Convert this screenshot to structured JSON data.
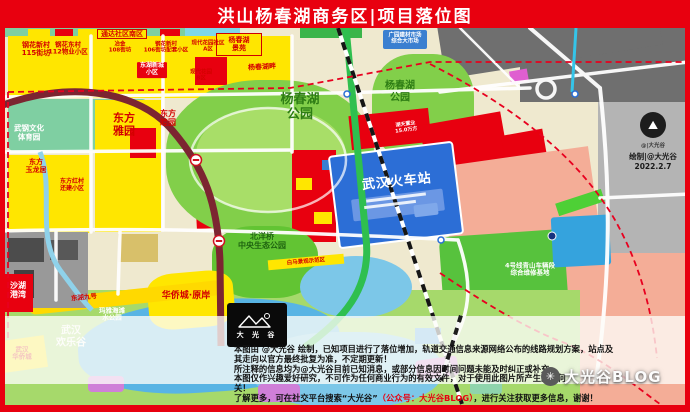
{
  "header": {
    "title": "洪山杨春湖商务区|项目落位图"
  },
  "colors": {
    "header_red": "#e8000f",
    "parcel_yellow": "#ffe600",
    "parcel_red": "#e8000f",
    "park_green": "#82cf4a",
    "station_blue": "#2c6ed6",
    "water_blue": "#58b4e4",
    "salmon": "#f4ad97",
    "gray_outside": "#b4b4b4"
  },
  "map": {
    "labels": [
      {
        "id": "ganghua-115",
        "text": "钢花新村\n115街坊"
      },
      {
        "id": "ganghua-112",
        "text": "钢花东村\n112物业小区"
      },
      {
        "id": "tongda",
        "text": "通达社区南区"
      },
      {
        "id": "yejin-108",
        "text": "冶金\n108街坊"
      },
      {
        "id": "ganghua-106",
        "text": "钢花新村\n106街坊配套小区"
      },
      {
        "id": "xiandai-a",
        "text": "现代花园社区\nA区"
      },
      {
        "id": "donghu-xincheng",
        "text": "东湖新城\n小区"
      },
      {
        "id": "xiandai-b",
        "text": "现代花园\nB区"
      },
      {
        "id": "yangchunhu-jingyuan",
        "text": "杨春湖\n景苑"
      },
      {
        "id": "yangchunhu-pan",
        "text": "杨春湖畔"
      },
      {
        "id": "jiancai-market",
        "text": "广园建材市场\n综合大市场"
      },
      {
        "id": "park-west",
        "text": "杨春湖\n公园"
      },
      {
        "id": "park-east",
        "text": "杨春湖\n公园"
      },
      {
        "id": "dongfang-yayuan",
        "text": "东方\n雅园"
      },
      {
        "id": "dongfang-muyuan",
        "text": "东方\n睦园"
      },
      {
        "id": "wugang-sports-park",
        "text": "武钢文化\n体育园"
      },
      {
        "id": "dongfang-yulongju",
        "text": "东方\n玉龙居"
      },
      {
        "id": "dongfanghongcun",
        "text": "东方红村\n还建小区"
      },
      {
        "id": "wuhan-railway-station",
        "text": "武汉火车站"
      },
      {
        "id": "hutian",
        "text": "湖天置业\n15.0万方"
      },
      {
        "id": "beiyangqiao-park",
        "text": "北洋桥\n中央生态公园"
      },
      {
        "id": "shahu-gangwan",
        "text": "沙湖\n港湾"
      },
      {
        "id": "donghu-no9",
        "text": "东湖九号"
      },
      {
        "id": "oct-yuanan",
        "text": "华侨城·原岸"
      },
      {
        "id": "maya-beach",
        "text": "玛雅海滩\n水公园"
      },
      {
        "id": "happy-valley",
        "text": "武汉\n欢乐谷"
      },
      {
        "id": "wuhan-oct",
        "text": "武汉\n华侨城"
      },
      {
        "id": "line4-depot",
        "text": "4号线青山车辆段\n综合维修基地"
      },
      {
        "id": "baima",
        "text": "白马景观示范区"
      }
    ]
  },
  "logo": {
    "text": "大 光 谷"
  },
  "credit": {
    "handle": "@|大光谷",
    "line": "绘制|@大光谷",
    "date": "2022.2.7"
  },
  "watermark": {
    "icon": "sparkle-icon",
    "text": "大光谷BLOG"
  },
  "disclaimer": {
    "l1": "本图由 @大光谷 绘制，已知项目进行了落位增加，轨道交通信息来源网络公布的线路规划方案，站点及",
    "l2": "其走向以官方最终批复为准，不定期更新！",
    "l3": "所注释的信息均为@大光谷目前已知消息，或部分信息因时间问题未能及时纠正或补充。",
    "l4": "本图仅作兴趣爱好研究，不可作为任何商业行为的有效文件，对于使用此图片所产生的任何",
    "l5": "关！",
    "l6a": "了解更多，可在社交平台搜索“大光谷”",
    "l6b": "（公众号：大光谷BLOG）",
    "l6c": "，进行关注获取更多信息，谢谢！"
  }
}
